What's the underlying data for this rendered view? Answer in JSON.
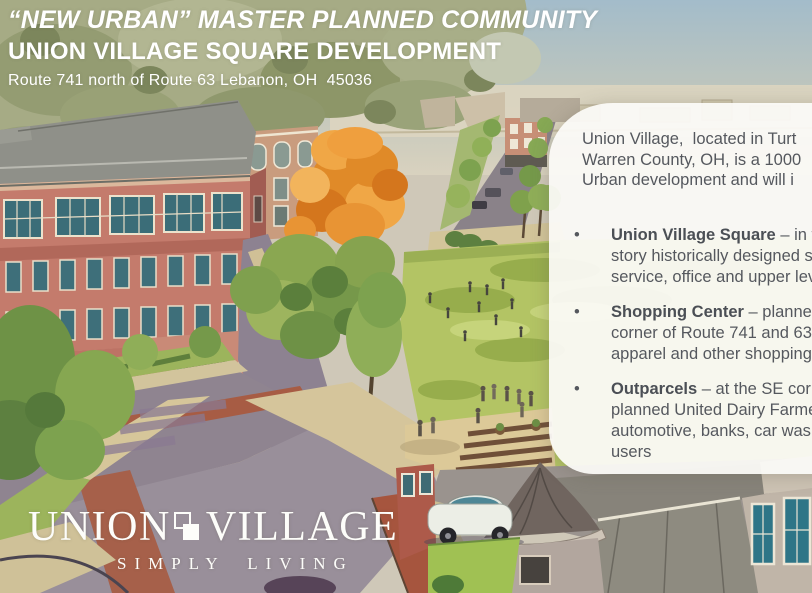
{
  "slide": {
    "header": {
      "tagline": "“NEW URBAN” MASTER PLANNED COMMUNITY",
      "title": "UNION VILLAGE SQUARE DEVELOPMENT",
      "address": "Route 741 north of Route 63 Lebanon, OH  45036"
    },
    "info_panel": {
      "intro_lines": [
        "Union Village,  located in Turt",
        "Warren County, OH, is a 1000",
        "Urban development and will i"
      ],
      "bullets": [
        {
          "marker": "•",
          "title": "Union Village Square",
          "title_suffix": " – in the ",
          "lines": [
            "story historically designed str",
            "service, office and upper leve"
          ]
        },
        {
          "marker": "•",
          "title": "Shopping Center",
          "title_suffix": " – planned 3",
          "lines": [
            "corner of Route 741 and 63.  ",
            "apparel and other shopping c"
          ]
        },
        {
          "marker": "•",
          "title": "Outparcels",
          "title_suffix": " – at the SE corner",
          "lines": [
            "planned United Dairy Farmer",
            "automotive, banks, car wash a",
            "users"
          ]
        }
      ]
    },
    "logo": {
      "word1": "UNION",
      "word2": "VILLAGE",
      "tagline": "SIMPLY LIVING"
    },
    "colors": {
      "header_text": "#ffffff",
      "panel_background": "#fbfaf6",
      "panel_text": "#55585e",
      "logo_text": "#fdfdfa",
      "brick_building": "#c47b6c",
      "autumn_tree_orange": "#e8922e",
      "lawn_green": "#b3c464",
      "sky_blue": "#a3bcca"
    }
  }
}
